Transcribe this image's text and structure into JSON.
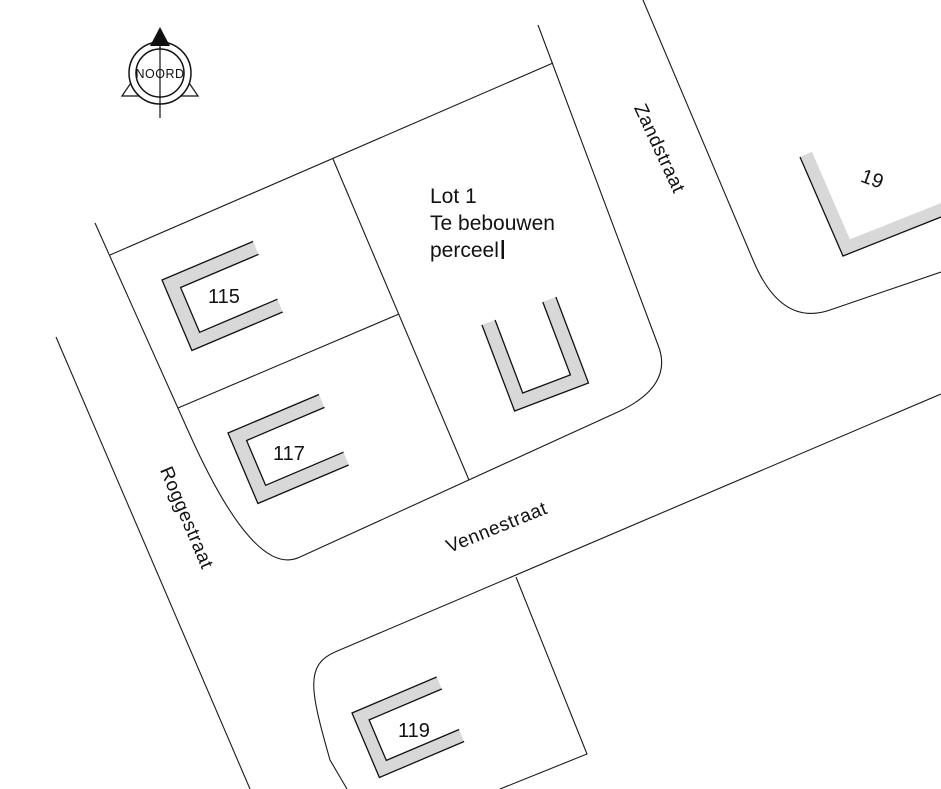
{
  "compass": {
    "label": "NOORD"
  },
  "streets": {
    "zandstraat": "Zandstraat",
    "roggestraat": "Roggestraat",
    "vennestraat": "Vennestraat"
  },
  "lot1": {
    "title": "Lot 1",
    "subtitle1": "Te bebouwen",
    "subtitle2": "perceel"
  },
  "buildings": {
    "b115": "115",
    "b117": "117",
    "b119": "119",
    "b19": "19"
  },
  "colors": {
    "background": "#ffffff",
    "line_color": "#1a1a1a",
    "building_fill": "#d8d8d8"
  }
}
